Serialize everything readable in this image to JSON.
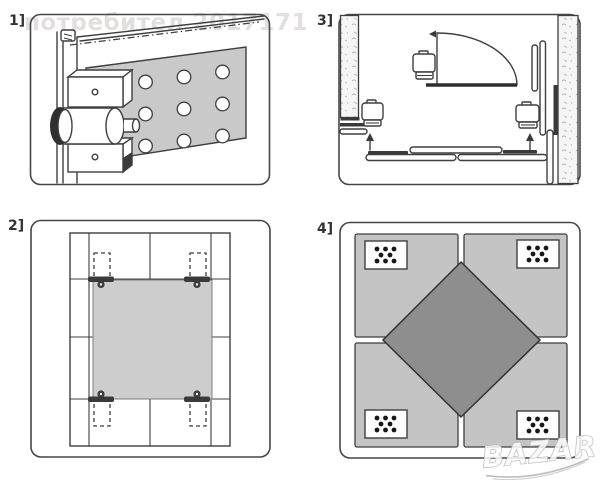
{
  "watermarks": {
    "user": "потребител 2017171",
    "logo": "BAZAR"
  },
  "panels": [
    {
      "label": "1]",
      "name": "lock-and-strike-plate-side-view"
    },
    {
      "label": "2]",
      "name": "mounting-plate-on-tiled-wall"
    },
    {
      "label": "3]",
      "name": "room-floor-plan-with-door-swing"
    },
    {
      "label": "4]",
      "name": "panel-layout-with-diamond-insert"
    }
  ],
  "colors": {
    "line": "#3f3f3f",
    "plate_gray": "#c9c9c9",
    "tile_plate_gray": "#cdcdcd",
    "quadrant_gray": "#c4c4c4",
    "diamond_gray": "#8e8e8e",
    "watermark_gray": "#e2dfdf",
    "logo_outline": "#b8b8b8",
    "background": "#ffffff"
  }
}
